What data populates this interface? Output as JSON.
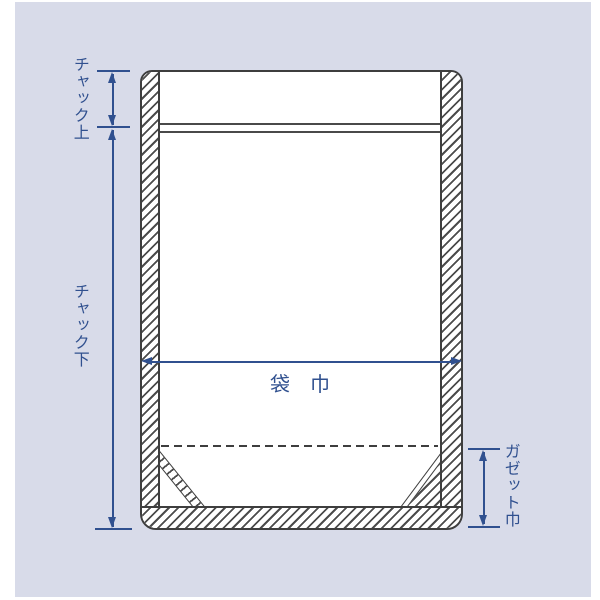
{
  "diagram": {
    "kind": "stand-up zipper pouch dimension drawing",
    "labels": {
      "chuck_top": "チャック上",
      "chuck_bottom": "チャック下",
      "bag_width": "袋　巾",
      "gusset_width": "ガゼット巾"
    },
    "colors": {
      "page_background": "#ffffff",
      "panel_background": "#d8dbe9",
      "outline": "#3e3e3e",
      "hatch_line": "#4c4c4c",
      "pouch_fill": "#ffffff",
      "dimension_blue": "#30508f"
    }
  }
}
